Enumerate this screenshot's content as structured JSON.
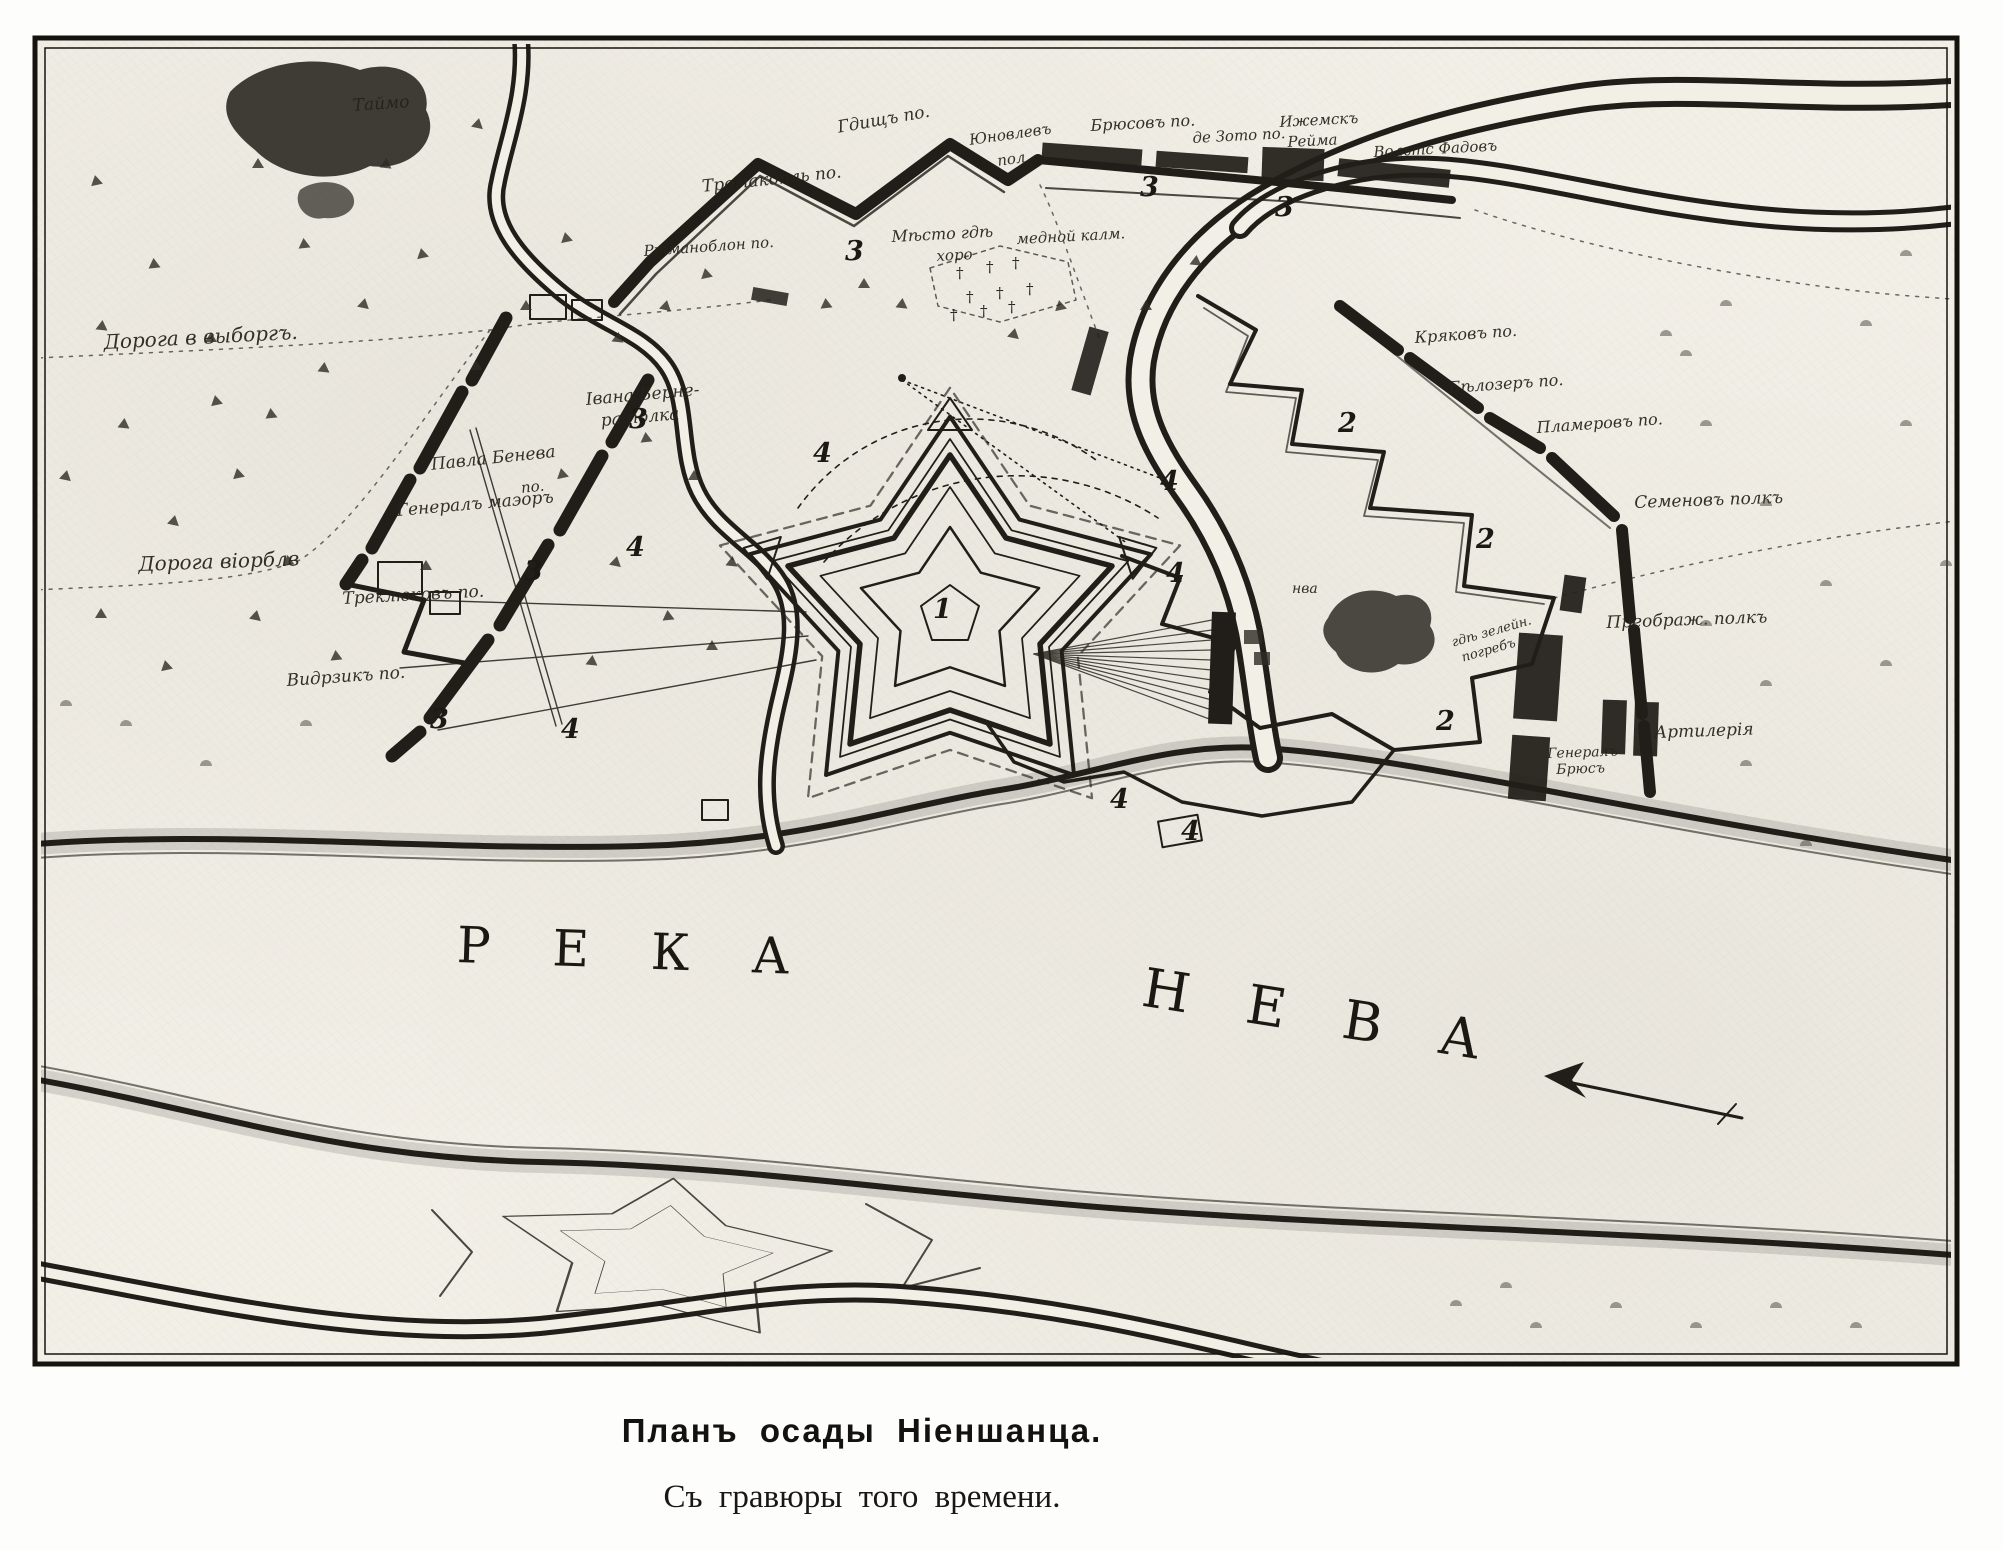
{
  "caption": {
    "title": "Планъ осады Ніеншанца.",
    "subtitle": "Съ гравюры того времени."
  },
  "colors": {
    "paper": "#f2efe7",
    "ink": "#211e19",
    "page": "#fdfdfb"
  },
  "river_words": [
    {
      "text": "РЕКА",
      "x": 458,
      "y": 916,
      "rot": 2,
      "ls": 62,
      "fs": 50
    },
    {
      "text": "НЕВА",
      "x": 1148,
      "y": 956,
      "rot": 9,
      "ls": 58,
      "fs": 54
    }
  ],
  "labels": [
    {
      "t": "Таймо",
      "x": 352,
      "y": 96,
      "r": -4,
      "s": 17
    },
    {
      "t": "Дорога в выборгъ.",
      "x": 103,
      "y": 330,
      "r": -3,
      "s": 20
    },
    {
      "t": "Дорога віорблв",
      "x": 138,
      "y": 552,
      "r": -2,
      "s": 20
    },
    {
      "t": "Івана Берне-",
      "x": 585,
      "y": 390,
      "r": -5,
      "s": 17
    },
    {
      "t": "ра полка",
      "x": 600,
      "y": 411,
      "r": -5,
      "s": 17
    },
    {
      "t": "Павла Бенева",
      "x": 430,
      "y": 455,
      "r": -6,
      "s": 17
    },
    {
      "t": "по.",
      "x": 520,
      "y": 479,
      "r": -6,
      "s": 15
    },
    {
      "t": "Генералъ маэоръ",
      "x": 396,
      "y": 501,
      "r": -5,
      "s": 17
    },
    {
      "t": "Треклюковъ по.",
      "x": 342,
      "y": 589,
      "r": -3,
      "s": 17
    },
    {
      "t": "Видрзикъ по.",
      "x": 286,
      "y": 671,
      "r": -4,
      "s": 17
    },
    {
      "t": "Ртманоблон по.",
      "x": 643,
      "y": 242,
      "r": -4,
      "s": 15
    },
    {
      "t": "Тромакопль по.",
      "x": 701,
      "y": 177,
      "r": -6,
      "s": 17
    },
    {
      "t": "Гдищъ по.",
      "x": 836,
      "y": 118,
      "r": -10,
      "s": 17
    },
    {
      "t": "Юновлевъ",
      "x": 968,
      "y": 131,
      "r": -8,
      "s": 15
    },
    {
      "t": "пол.",
      "x": 996,
      "y": 152,
      "r": -8,
      "s": 15
    },
    {
      "t": "Брюсовъ по.",
      "x": 1090,
      "y": 116,
      "r": -3,
      "s": 16
    },
    {
      "t": "де Зото по.",
      "x": 1192,
      "y": 129,
      "r": -3,
      "s": 15
    },
    {
      "t": "Ижемскъ",
      "x": 1279,
      "y": 113,
      "r": -3,
      "s": 15
    },
    {
      "t": "Рейма",
      "x": 1287,
      "y": 133,
      "r": -3,
      "s": 15
    },
    {
      "t": "Вольтс Фадовъ",
      "x": 1373,
      "y": 143,
      "r": -3,
      "s": 15
    },
    {
      "t": "Мѣсто гдѣ",
      "x": 891,
      "y": 227,
      "r": -3,
      "s": 16
    },
    {
      "t": "хоро",
      "x": 936,
      "y": 247,
      "r": -3,
      "s": 15
    },
    {
      "t": "медной калм.",
      "x": 1016,
      "y": 230,
      "r": -3,
      "s": 15
    },
    {
      "t": "Кряковъ по.",
      "x": 1414,
      "y": 328,
      "r": -4,
      "s": 16
    },
    {
      "t": "Бѣлозеръ по.",
      "x": 1448,
      "y": 378,
      "r": -4,
      "s": 16
    },
    {
      "t": "Пламеровъ по.",
      "x": 1536,
      "y": 418,
      "r": -4,
      "s": 16
    },
    {
      "t": "Семеновъ полкъ",
      "x": 1634,
      "y": 493,
      "r": -2,
      "s": 17
    },
    {
      "t": "Преображ. полкъ",
      "x": 1606,
      "y": 613,
      "r": -2,
      "s": 17
    },
    {
      "t": "Артилерія",
      "x": 1654,
      "y": 723,
      "r": -2,
      "s": 17
    },
    {
      "t": "Генералъ",
      "x": 1547,
      "y": 746,
      "r": -2,
      "s": 14
    },
    {
      "t": "Брюсъ",
      "x": 1556,
      "y": 762,
      "r": -2,
      "s": 14
    },
    {
      "t": "нва",
      "x": 1292,
      "y": 581,
      "r": 0,
      "s": 14
    },
    {
      "t": "гдѣ зелейн.",
      "x": 1450,
      "y": 636,
      "r": -16,
      "s": 13
    },
    {
      "t": "погребъ",
      "x": 1460,
      "y": 651,
      "r": -16,
      "s": 13
    }
  ],
  "markers": [
    {
      "n": "1",
      "x": 933,
      "y": 596
    },
    {
      "n": "2",
      "x": 1338,
      "y": 410
    },
    {
      "n": "2",
      "x": 1476,
      "y": 526
    },
    {
      "n": "2",
      "x": 1436,
      "y": 708
    },
    {
      "n": "3",
      "x": 845,
      "y": 238
    },
    {
      "n": "3",
      "x": 1140,
      "y": 174
    },
    {
      "n": "3",
      "x": 1275,
      "y": 194
    },
    {
      "n": "3",
      "x": 629,
      "y": 406
    },
    {
      "n": "3",
      "x": 524,
      "y": 558
    },
    {
      "n": "3",
      "x": 430,
      "y": 706
    },
    {
      "n": "4",
      "x": 813,
      "y": 440
    },
    {
      "n": "4",
      "x": 1160,
      "y": 468
    },
    {
      "n": "4",
      "x": 1166,
      "y": 560
    },
    {
      "n": "4",
      "x": 626,
      "y": 534
    },
    {
      "n": "4",
      "x": 561,
      "y": 716
    },
    {
      "n": "4",
      "x": 1110,
      "y": 786
    },
    {
      "n": "4",
      "x": 1181,
      "y": 818
    }
  ]
}
